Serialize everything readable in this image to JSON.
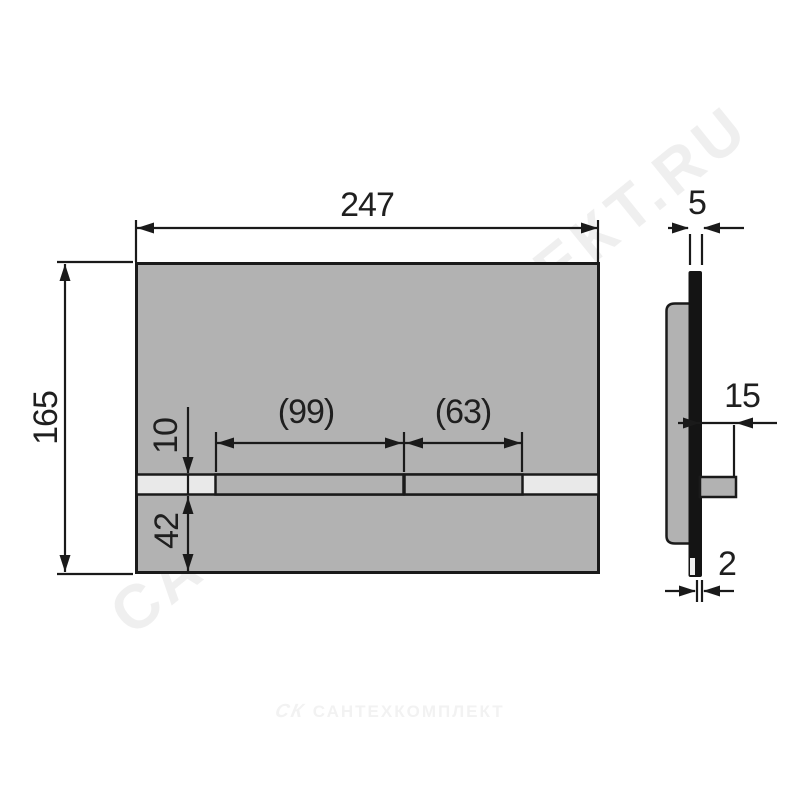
{
  "drawing": {
    "front_view": {
      "width": "247",
      "height": "165",
      "large_button_width": "(99)",
      "small_button_width": "(63)",
      "strip_height": "10",
      "strip_bottom_offset": "42"
    },
    "side_view": {
      "total_thickness": "5",
      "button_depth": "15",
      "panel_thickness": "2"
    },
    "watermark": {
      "logo": "СК",
      "text": "САНТЕХКОМПЛЕКТ",
      "diagonal_text": "САНТЕХКОМПЛЕКТ.RU"
    },
    "colors": {
      "plate": "#b2b2b2",
      "strip": "#e9e9e9",
      "line": "#1a1a1a",
      "background": "#ffffff"
    }
  }
}
